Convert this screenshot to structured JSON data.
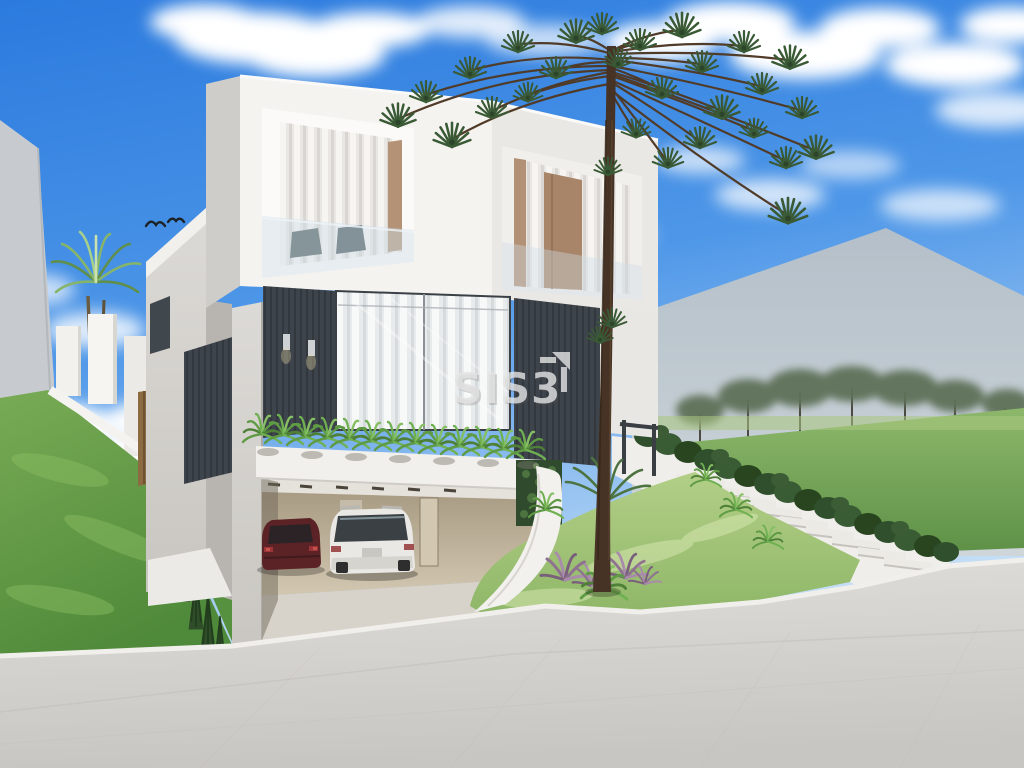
{
  "watermark": {
    "text": "SIS3",
    "icon": "corner-arrow-up-right-icon",
    "color": "#e2e2e2"
  },
  "scene": {
    "type": "architectural-exterior-3d-render",
    "subject": "modern two-story white house with open carport on a sloped street corner lot",
    "visible_elements": [
      "blue sky with clouds",
      "two birds flying",
      "araucaria pine tree in front of house",
      "palm tree behind left boundary wall",
      "left grass slope with white stepped wall and wooden fence",
      "open carport with dark red sedan and white SUV",
      "fern planter over carport beam",
      "dark slatted facade panels with wall sconces",
      "glass windows with white curtains",
      "right lawn with hedge, white retaining wall and outdoor staircase",
      "gray neighbor buildings left and right",
      "paved street and curb in foreground"
    ],
    "palette": {
      "sky": "#2b7ade",
      "grass": "#6aa14c",
      "street": "#d8d5d1",
      "house_white": "#f3f2ef",
      "dark_panel": "#3e444b",
      "hedge": "#314e2e",
      "sedan": "#5c2327",
      "suv": "#e9e8e4",
      "tree_trunk": "#463325"
    }
  }
}
